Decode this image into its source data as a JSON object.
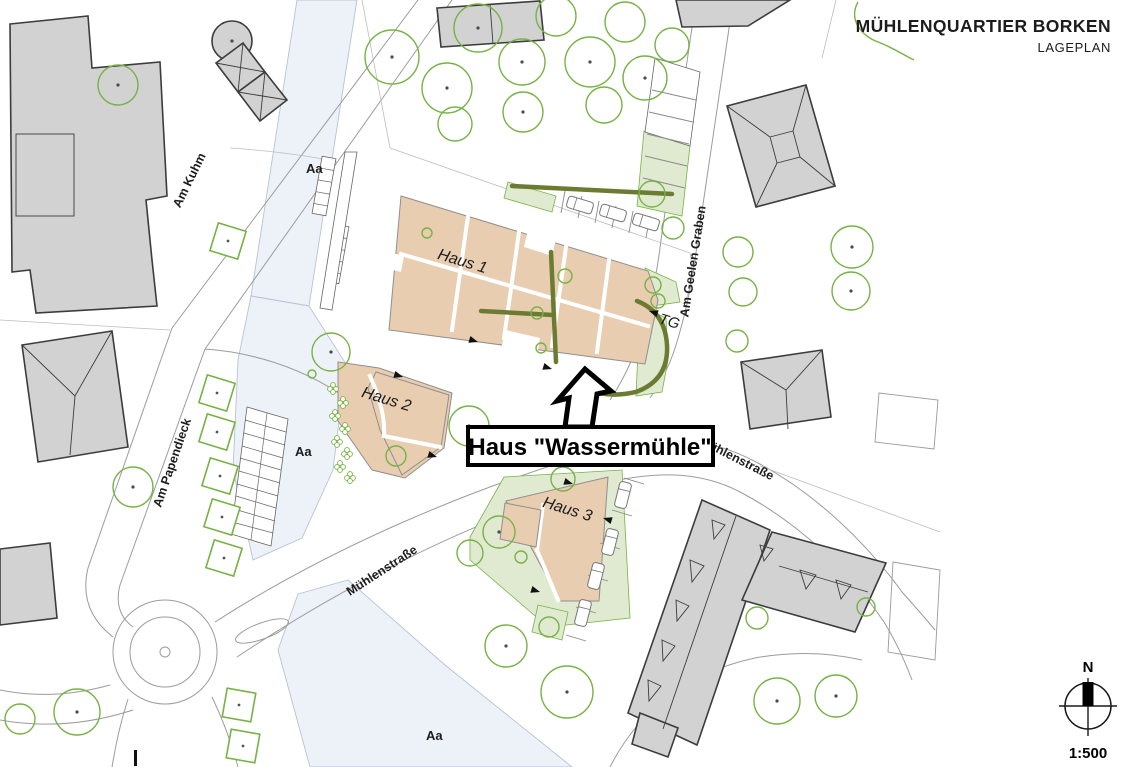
{
  "header": {
    "title": "MÜHLENQUARTIER BORKEN",
    "subtitle": "LAGEPLAN"
  },
  "legend": {
    "north_label": "N",
    "scale": "1:500"
  },
  "callout": {
    "label": "Haus \"Wassermühle\""
  },
  "buildings": {
    "haus1": "Haus 1",
    "haus2": "Haus 2",
    "haus3": "Haus 3",
    "underground_garage": "TG"
  },
  "streets": {
    "am_kuhm": "Am Kuhm",
    "am_papendieck": "Am Papendieck",
    "am_geelen_graben": "Am Geelen Graben",
    "muehlenstrasse_upper": "Mühlenstraße",
    "muehlenstrasse_lower": "Mühlenstraße"
  },
  "river": {
    "label_top": "Aa",
    "label_middle": "Aa",
    "label_bottom": "Aa"
  },
  "colors": {
    "site_tan": "#e8cdb0",
    "site_stroke": "#8f8f8f",
    "building_gray": "#d2d2d2",
    "building_stroke": "#3c3c3c",
    "tree_green": "#77b244",
    "landscape_green": "#e0ead0",
    "hedge_olive": "#6c7b32",
    "river_blue": "#edf1f8",
    "river_stroke": "#b9c1d6",
    "road_gray": "#9c9c9c",
    "parcel_gray": "#bdbdbd",
    "text_dark": "#1c1c1c"
  }
}
